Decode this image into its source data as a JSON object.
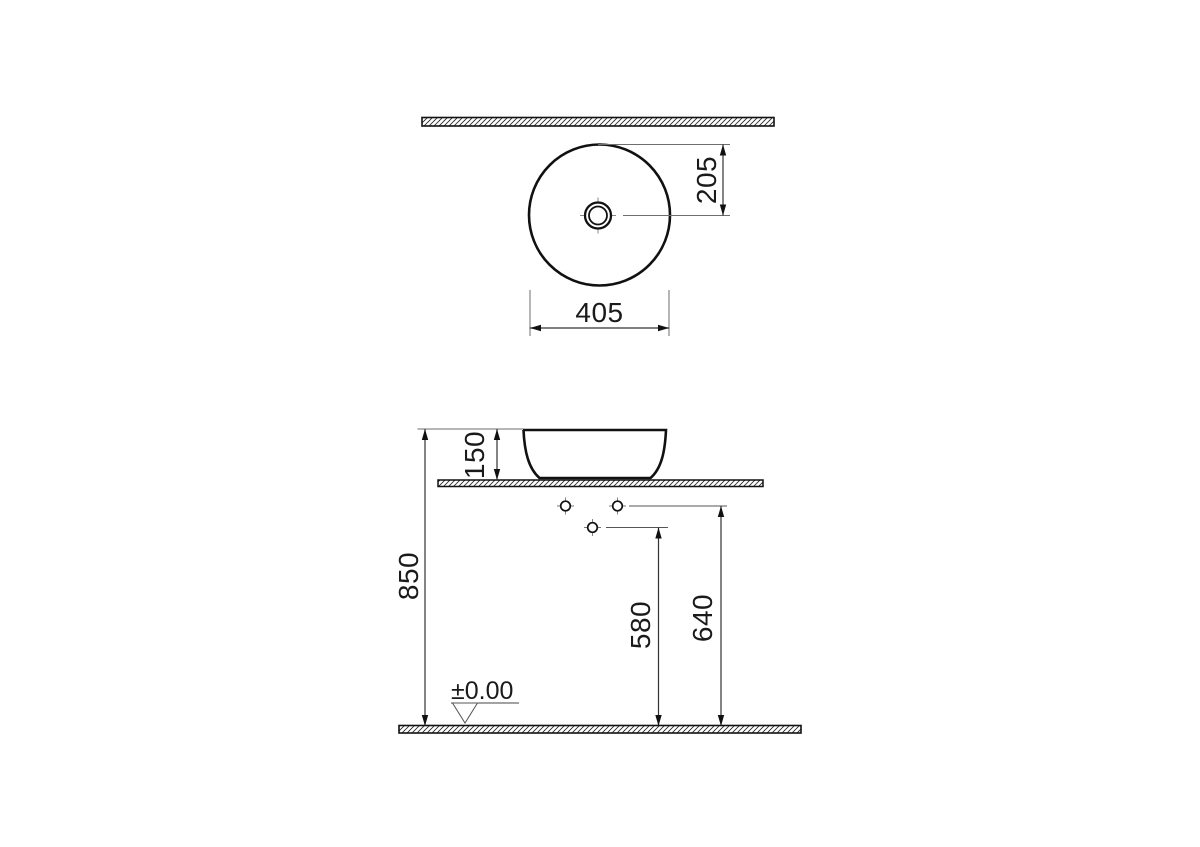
{
  "drawing": {
    "type": "technical-dimension-drawing",
    "subject": "round-countertop-washbasin",
    "colors": {
      "background": "#ffffff",
      "object_line": "#111111",
      "dimension_line": "#333333",
      "extension_line": "#6e6e6e",
      "text": "#1a1a1a"
    },
    "top_view": {
      "diameter": "405",
      "drain_center_offset": "205"
    },
    "front_view": {
      "basin_height": "150",
      "counter_height": "850",
      "drain_outlet_height": "580",
      "supply_line_height": "640",
      "floor_level": "±0.00"
    }
  }
}
